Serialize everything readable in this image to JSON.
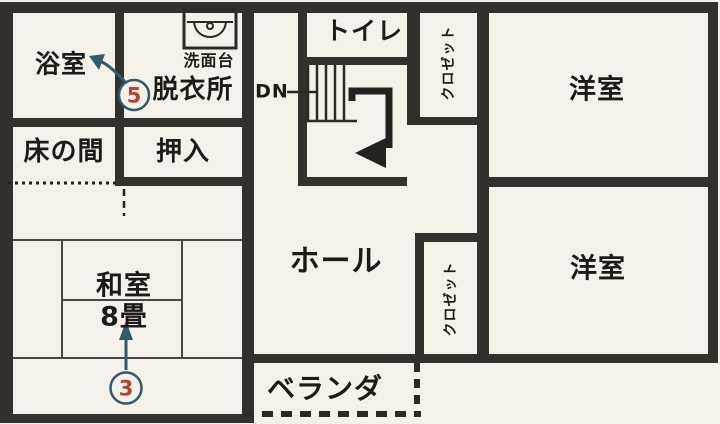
{
  "document": {
    "type": "floor-plan-scan",
    "floor_note": "upper floor (stairs marked DN)"
  },
  "colors": {
    "paper": "#f3f1e8",
    "wall": "#33312e",
    "ink": "#1c1b19",
    "annotation_red": "#b44237",
    "annotation_navy": "#33596b"
  },
  "rooms": {
    "bathroom": "浴室",
    "washstand": "洗面台",
    "dressing_room": "脱衣所",
    "tokonoma": "床の間",
    "oshiire": "押入",
    "toilet": "トイレ",
    "closet_upper": "クロゼット",
    "closet_lower": "クロゼット",
    "western_room_upper": "洋室",
    "western_room_lower": "洋室",
    "hall": "ホール",
    "japanese_room": "和室",
    "japanese_room_size": "8畳",
    "veranda": "ベランダ"
  },
  "stairs": {
    "direction_label": "DN"
  },
  "annotations": {
    "bathroom_marker": "5",
    "japanese_room_marker": "3"
  }
}
